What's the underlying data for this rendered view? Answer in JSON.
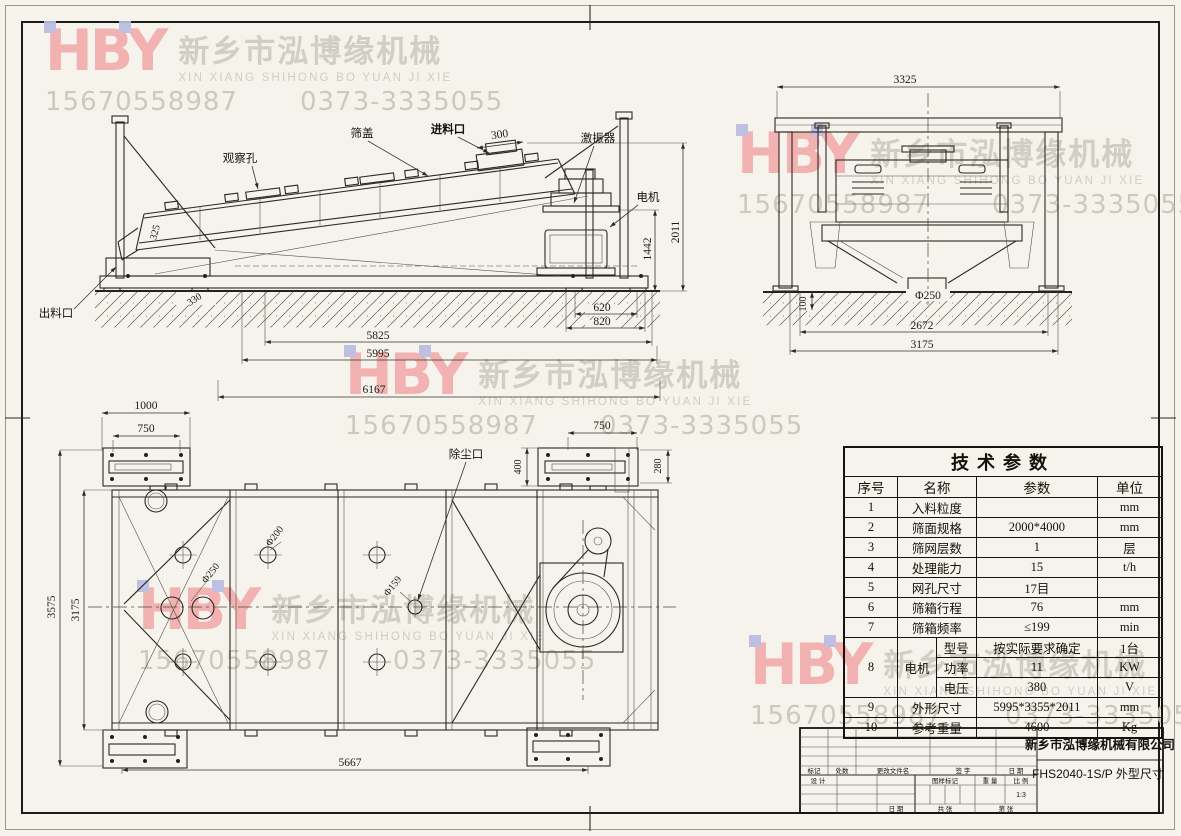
{
  "watermark": {
    "logo": "HBY",
    "company_cn": "新乡市泓博缘机械",
    "company_pinyin": "XIN XIANG SHIHONG BO YUAN JI XIE",
    "phone1": "15670558987",
    "phone2": "0373-3335055",
    "logo_color": "#f2adad",
    "accent_color": "#b9bce0",
    "text_color": "#cdcabf"
  },
  "side_view": {
    "labels": {
      "observation_hole": "观察孔",
      "screen_cover": "筛盖",
      "feed_inlet": "进料口",
      "exciter": "激振器",
      "motor": "电机",
      "discharge_outlet": "出料口"
    },
    "dims": {
      "feed_opening": "300",
      "left_note": "325",
      "base_offset": "330",
      "motor_base_1": "620",
      "motor_base_2": "820",
      "span_1": "5825",
      "span_2": "5995",
      "span_3": "6167",
      "height_exciter": "1442",
      "height_total": "2011"
    }
  },
  "end_view": {
    "dims": {
      "width_top": "3325",
      "ground_depth": "100",
      "chute_dia": "Φ250",
      "width_inner": "2672",
      "width_outer": "3175"
    }
  },
  "plan_view": {
    "labels": {
      "dust_port": "除尘口"
    },
    "dims": {
      "flange_w": "1000",
      "flange_bolt_w": "750",
      "dust_flange_w": "750",
      "dust_flange_h1": "400",
      "dust_flange_h2": "280",
      "width_outer": "3575",
      "width_inner": "3175",
      "length": "5667",
      "hole_1": "Φ250",
      "hole_2": "Φ200",
      "hole_3": "Φ159"
    }
  },
  "table": {
    "title": "技术参数",
    "headers": [
      "序号",
      "名称",
      "参数",
      "单位"
    ],
    "rows": [
      [
        "1",
        "入料粒度",
        "",
        "mm"
      ],
      [
        "2",
        "筛面规格",
        "2000*4000",
        "mm"
      ],
      [
        "3",
        "筛网层数",
        "1",
        "层"
      ],
      [
        "4",
        "处理能力",
        "15",
        "t/h"
      ],
      [
        "5",
        "网孔尺寸",
        "17目",
        ""
      ],
      [
        "6",
        "筛箱行程",
        "76",
        "mm"
      ],
      [
        "7",
        "筛箱频率",
        "≤199",
        "min"
      ]
    ],
    "motor": {
      "no": "8",
      "name": "电机",
      "subrows": [
        [
          "型号",
          "按实际要求确定",
          "1台"
        ],
        [
          "功率",
          "11",
          "KW"
        ],
        [
          "电压",
          "380",
          "V"
        ]
      ]
    },
    "rows2": [
      [
        "9",
        "外形尺寸",
        "5995*3355*2011",
        "mm"
      ],
      [
        "10",
        "参考重量",
        "4600",
        "Kg"
      ]
    ]
  },
  "title_block": {
    "company": "新乡市泓博缘机械有限公司",
    "drawing_no": "FHS2040-1S/P  外型尺寸",
    "scale_value": "1:3",
    "labels": {
      "mark": "标记",
      "count": "处数",
      "file": "更改文件名",
      "sign": "签 字",
      "date": "日 期",
      "design": "设 计",
      "date2": "日 期",
      "pattern_mark": "图样标记",
      "weight": "重 量",
      "scale": "比 例",
      "total": "共  张",
      "page": "第  张"
    }
  }
}
